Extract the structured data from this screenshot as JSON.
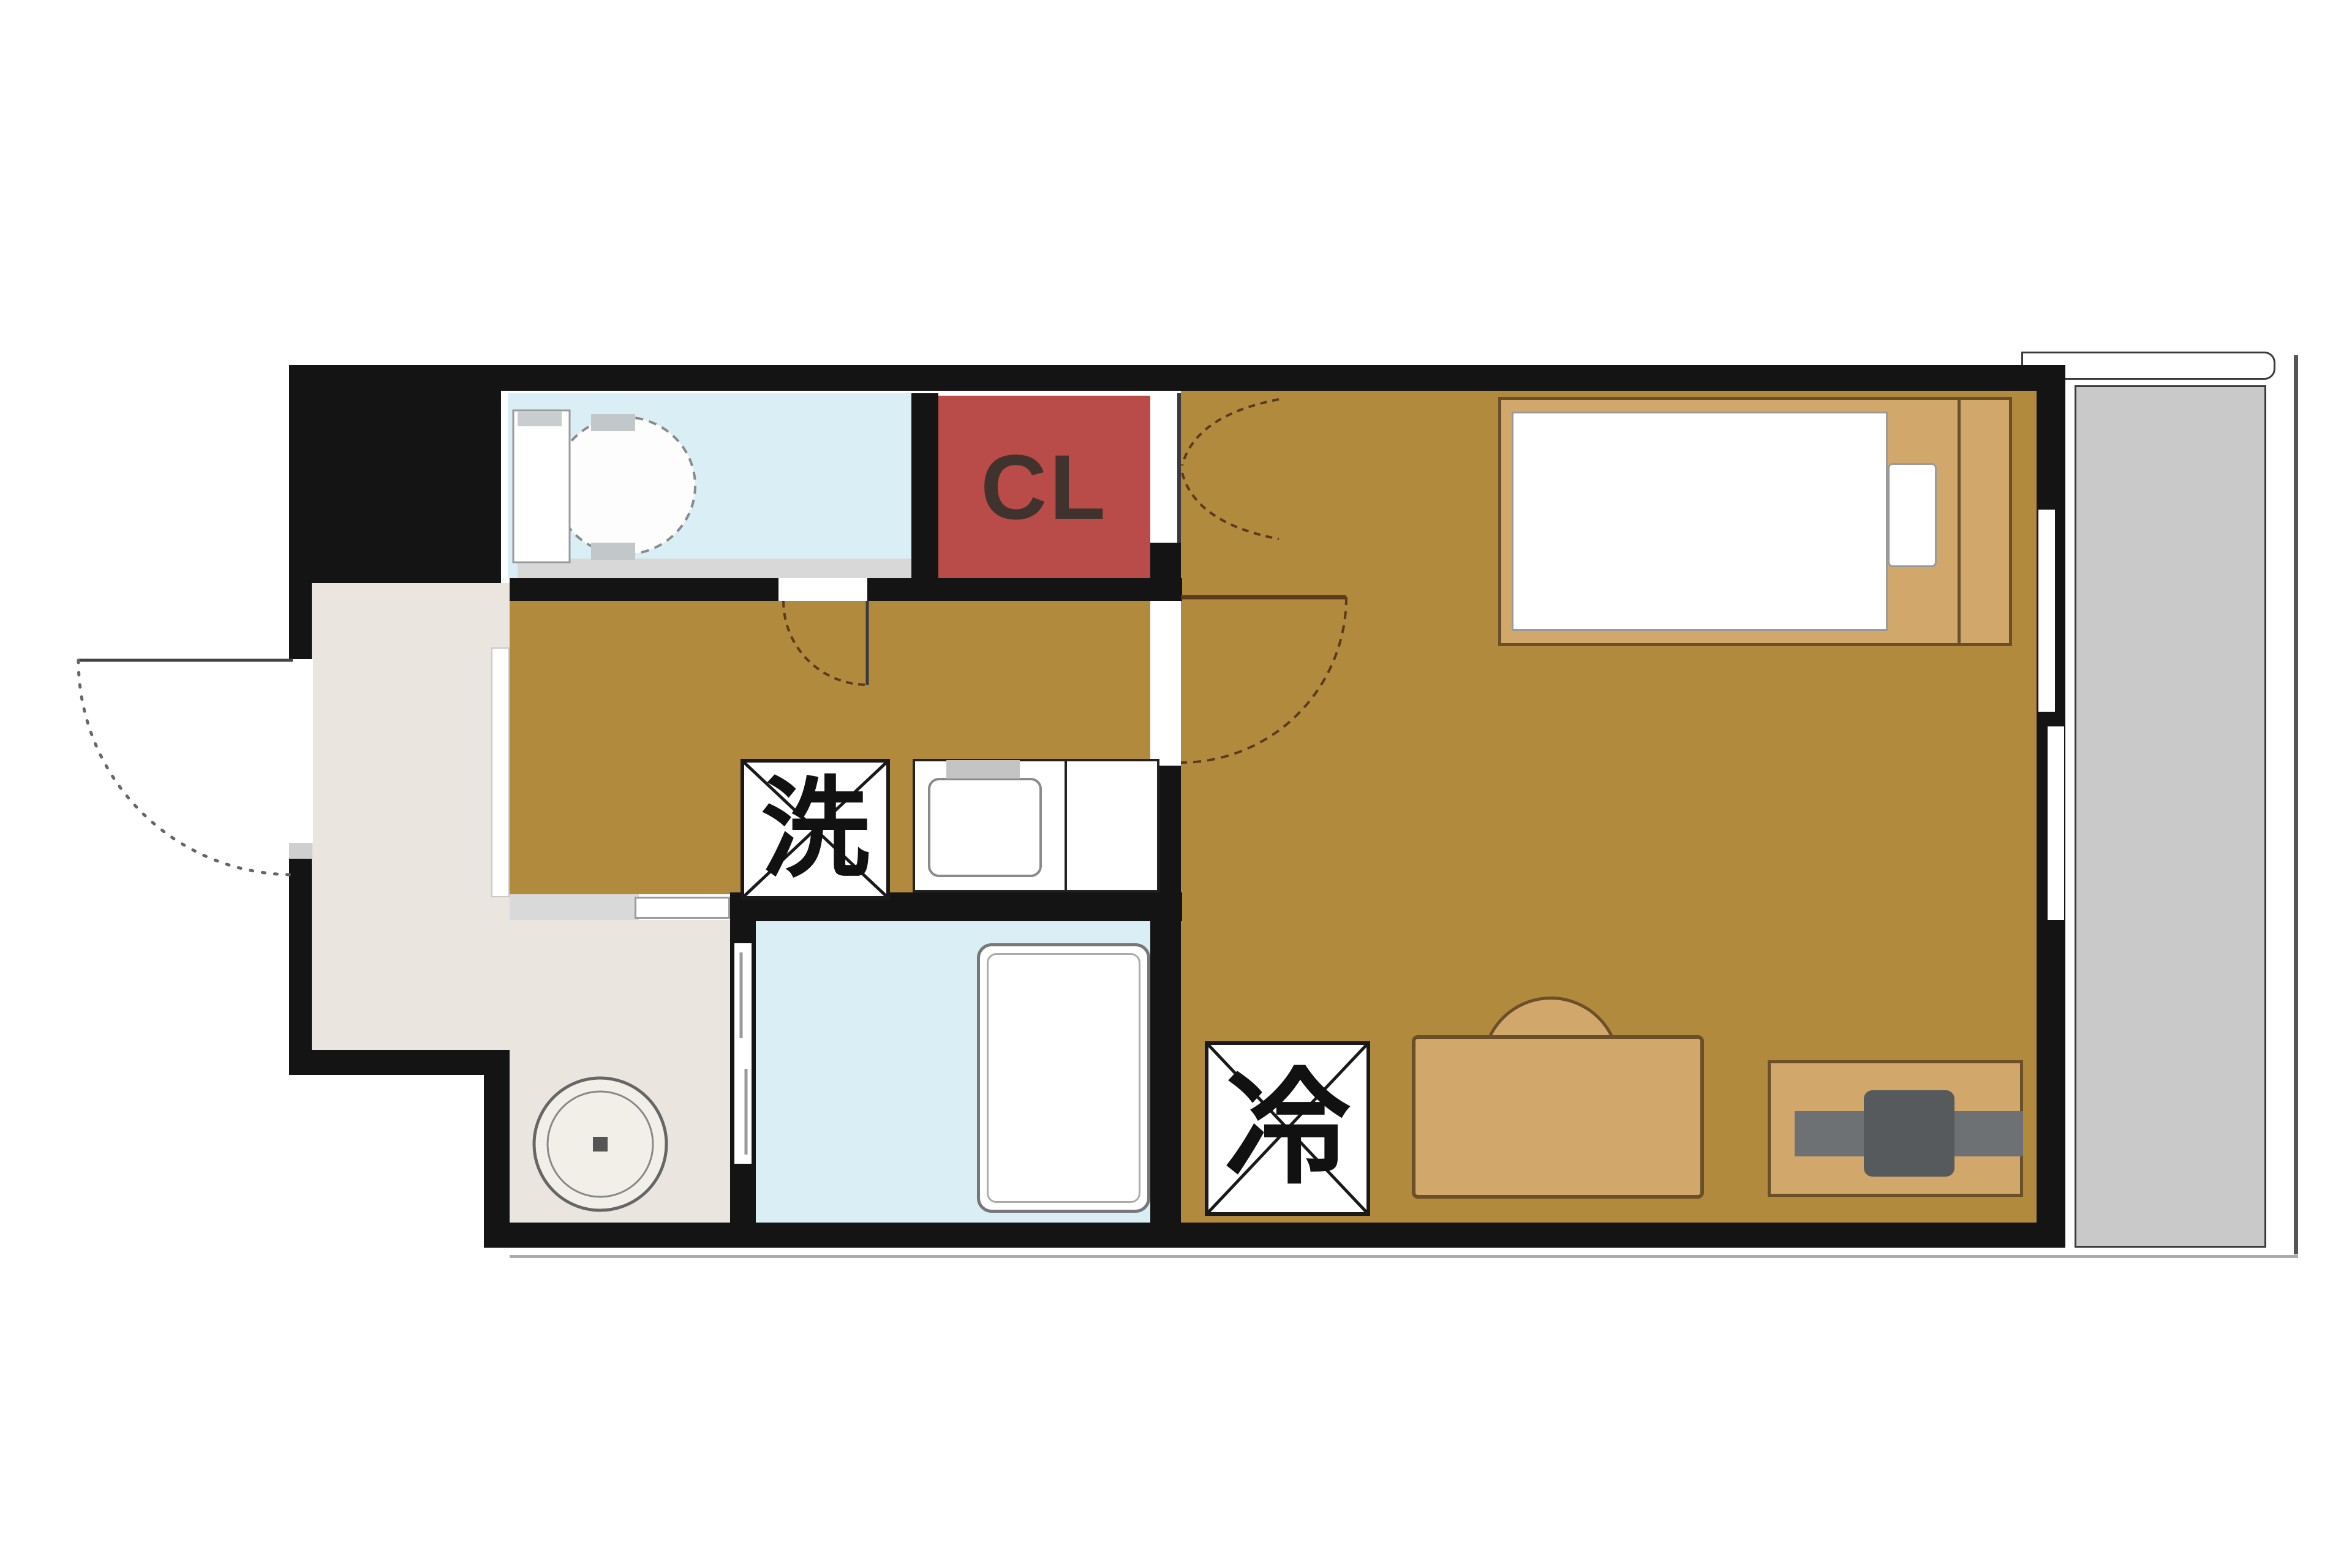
{
  "floorplan": {
    "kind": "apartment-floor-plan",
    "labels": {
      "closet": "CL",
      "washing_machine_space": "洗",
      "refrigerator_space": "冷"
    },
    "rooms": [
      {
        "name": "main-room",
        "floor_color": "#b28a3e"
      },
      {
        "name": "hallway-kitchen",
        "floor_color": "#b28a3e"
      },
      {
        "name": "toilet",
        "floor_color": "#d9eef5"
      },
      {
        "name": "bathroom",
        "floor_color": "#d9eef5"
      },
      {
        "name": "washroom",
        "floor_color": "#eae6df"
      },
      {
        "name": "entrance",
        "floor_color": "#eae6df"
      },
      {
        "name": "closet",
        "floor_color": "#b94c48"
      },
      {
        "name": "balcony",
        "floor_color": "#c9c9c9"
      },
      {
        "name": "pipe-shaft",
        "floor_color": "#141414"
      }
    ],
    "furniture": [
      "bed",
      "mattress",
      "pillow",
      "sofa-chair",
      "desk",
      "desk-chair",
      "kitchen-counter",
      "kitchen-sink",
      "bathtub",
      "toilet-fixture",
      "washing-machine-circle",
      "washing-machine-box",
      "refrigerator-box"
    ],
    "colors": {
      "wall": "#141414",
      "flooring_brown": "#b28a3e",
      "wet_area_blue": "#d9eef5",
      "closet_red": "#b94c48",
      "entrance_beige": "#eae6df",
      "balcony_gray": "#c9c9c9",
      "furniture_tan": "#d2a76c",
      "furniture_outline": "#6b4f28",
      "chair_gray": "#6e7173",
      "door_arc_brown": "#5a3a1e",
      "label_text": "#111111",
      "cl_text": "#40332e"
    }
  }
}
